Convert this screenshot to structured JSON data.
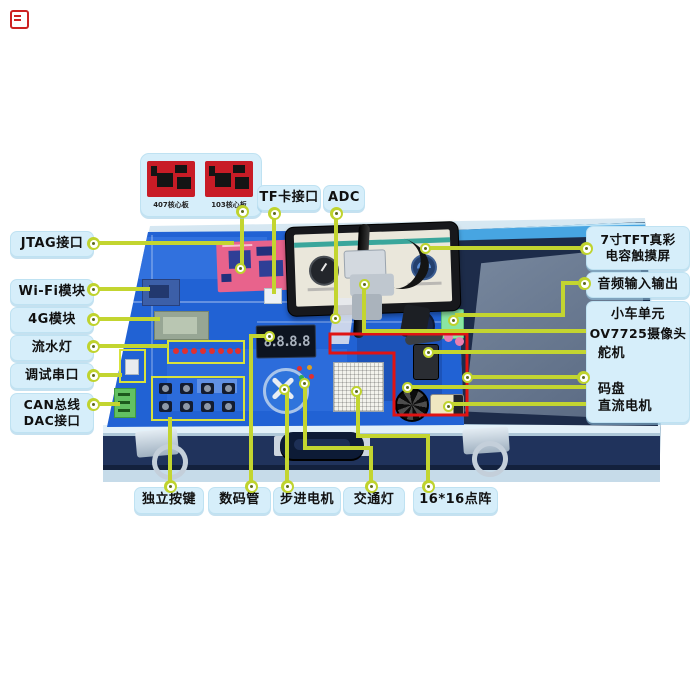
{
  "corner_icon": {
    "name": "red-list-icon"
  },
  "colors": {
    "leader_line": "#c3d530",
    "label_bg": "#d6eefa",
    "red_outline": "#e01313",
    "board_blue": "#2162d4",
    "case_navy": "#1d2c4a"
  },
  "inset": {
    "boards": [
      {
        "caption": "407核心板"
      },
      {
        "caption": "103核心板"
      }
    ]
  },
  "labels": {
    "left": [
      {
        "text": "JTAG接口"
      },
      {
        "text": "Wi-Fi模块"
      },
      {
        "text": "4G模块"
      },
      {
        "text": "流水灯"
      },
      {
        "text": "调试串口"
      },
      {
        "line1": "CAN总线",
        "line2": "DAC接口"
      }
    ],
    "top": [
      {
        "text": "TF卡接口"
      },
      {
        "text": "ADC"
      }
    ],
    "right": {
      "tft": {
        "line1": "7寸TFT真彩",
        "line2": "电容触摸屏"
      },
      "audio": {
        "text": "音频输入输出"
      },
      "car_unit": {
        "title": "小车单元",
        "camera": "OV7725摄像头",
        "servo": "舵机",
        "encoder": "码盘",
        "motor": "直流电机"
      }
    },
    "bottom": [
      {
        "text": "独立按键"
      },
      {
        "text": "数码管"
      },
      {
        "text": "步进电机"
      },
      {
        "text": "交通灯"
      },
      {
        "text": "16*16点阵"
      }
    ]
  },
  "board": {
    "seven_segment": "8.8.8.8"
  }
}
